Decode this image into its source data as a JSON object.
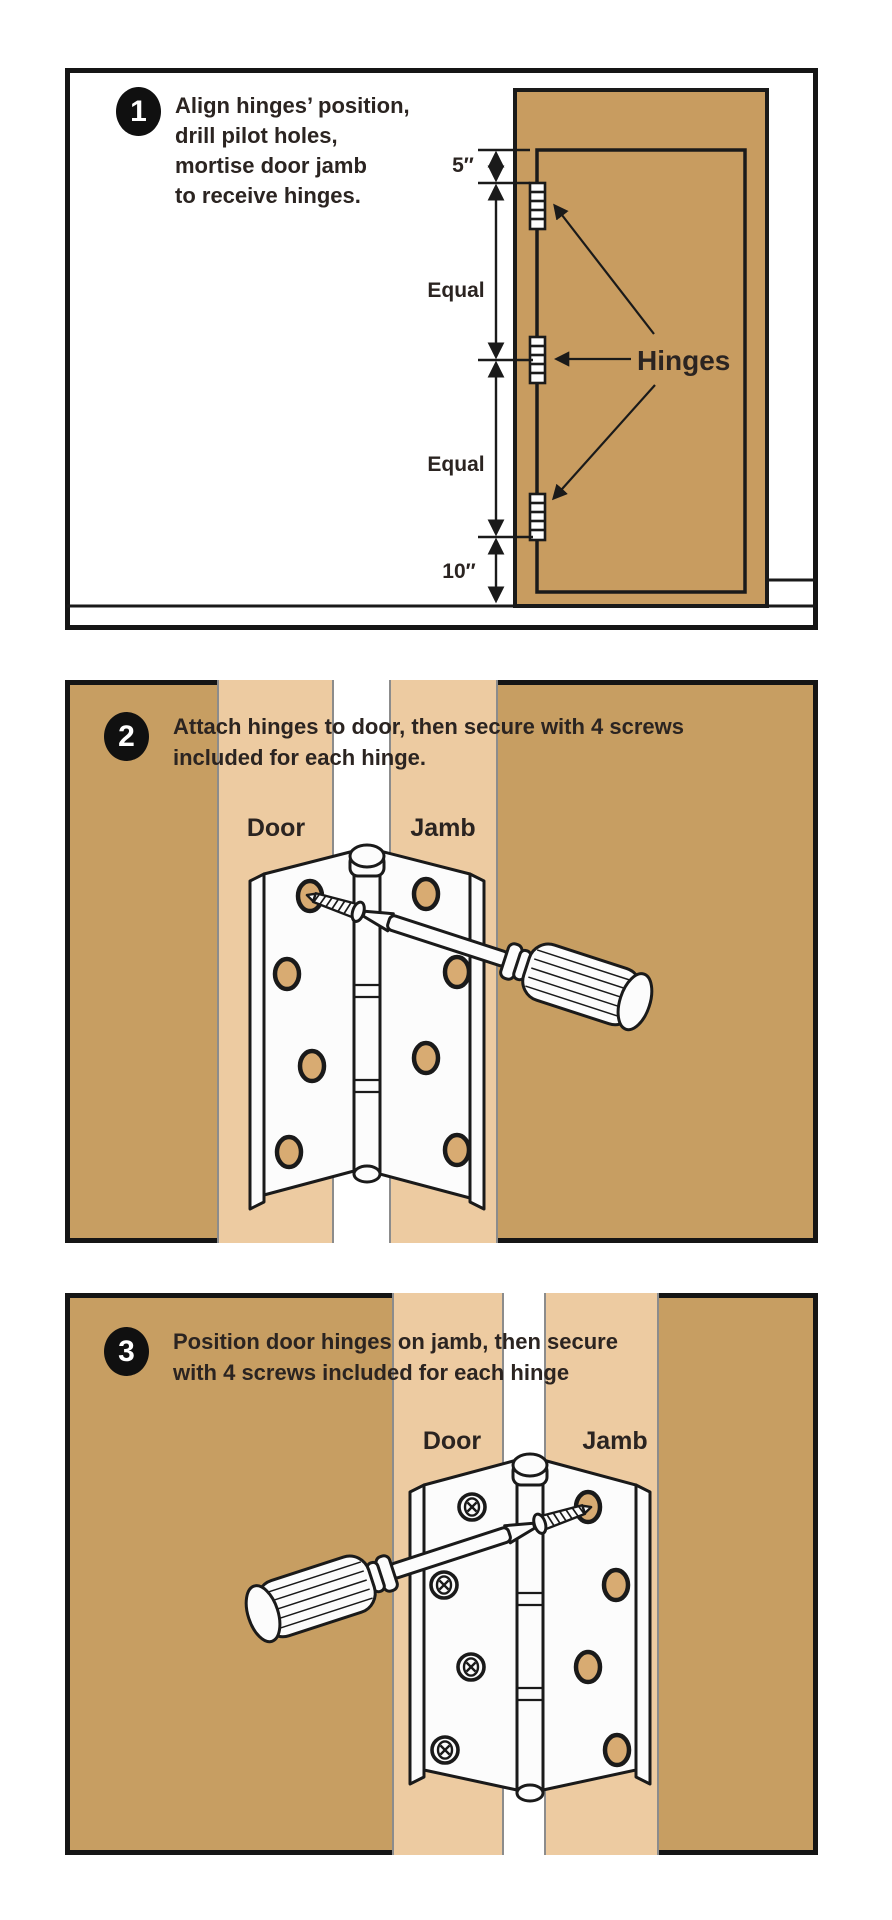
{
  "colors": {
    "wall_tan": "#C79E62",
    "strip_tan": "#EDCBA1",
    "strip_edge_gray": "#8C8C8C",
    "hole_tan": "#D8AB72",
    "outline": "#1a1a1a",
    "text": "#2b2421",
    "badge_bg": "#101010",
    "badge_text": "#ffffff"
  },
  "steps": [
    {
      "number": "1",
      "lines": [
        "Align hinges’  position,",
        "drill pilot holes,",
        "mortise door jamb",
        "to receive hinges."
      ]
    },
    {
      "number": "2",
      "lines": [
        "Attach hinges to door, then secure with 4 screws",
        "included for each hinge."
      ]
    },
    {
      "number": "3",
      "lines": [
        "Position door hinges on jamb, then secure",
        "with 4 screws included for each hinge"
      ]
    }
  ],
  "panel1": {
    "dim_top": "5″",
    "dim_equal_upper": "Equal",
    "dim_equal_lower": "Equal",
    "dim_bottom": "10″",
    "hinges_label": "Hinges"
  },
  "panel2": {
    "door_label": "Door",
    "jamb_label": "Jamb"
  },
  "panel3": {
    "door_label": "Door",
    "jamb_label": "Jamb"
  }
}
